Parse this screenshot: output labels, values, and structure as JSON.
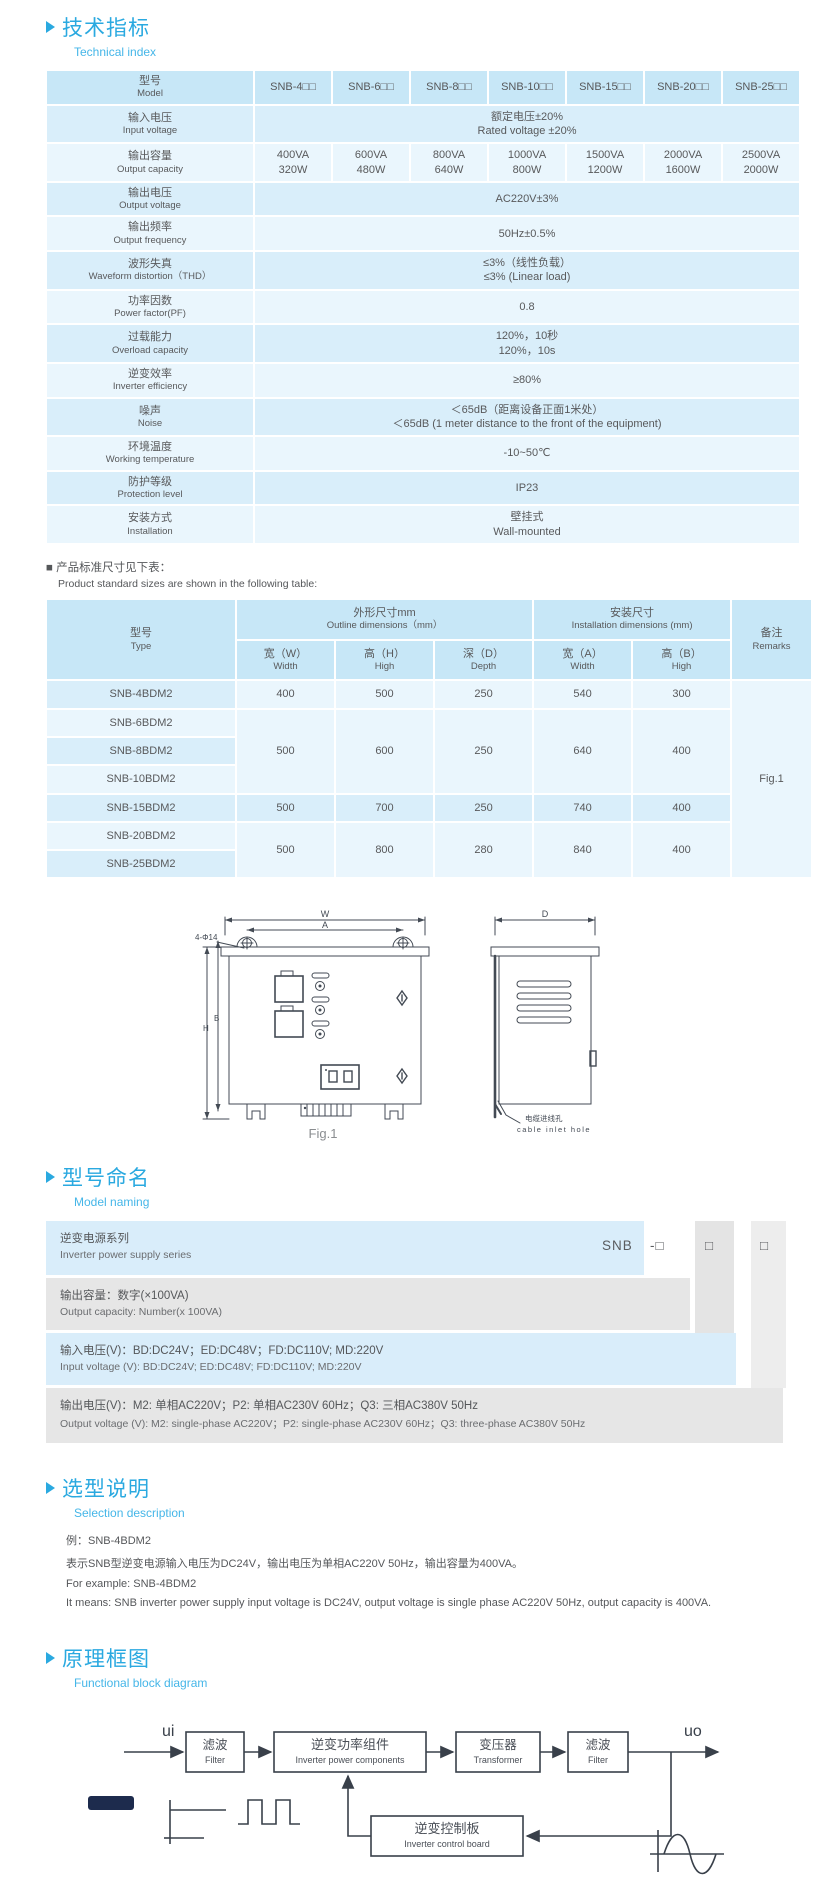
{
  "colors": {
    "heading_blue": "#2aa9e0",
    "subtitle_blue": "#45b6e8",
    "table_header_bg": "#c7e7f7",
    "row_dark": "#d9eefa",
    "row_light": "#eaf6fd",
    "naming_gray": "#e6e6e6",
    "line_dark": "#3a414b"
  },
  "sections": {
    "technical": {
      "title": "技术指标",
      "subtitle": "Technical index"
    },
    "naming": {
      "title": "型号命名",
      "subtitle": "Model naming"
    },
    "selection": {
      "title": "选型说明",
      "subtitle": "Selection description"
    },
    "diagram": {
      "title": "原理框图",
      "subtitle": "Functional block diagram"
    }
  },
  "spec_table": {
    "header": {
      "label_zh": "型号",
      "label_en": "Model",
      "models": [
        "SNB-4□□",
        "SNB-6□□",
        "SNB-8□□",
        "SNB-10□□",
        "SNB-15□□",
        "SNB-20□□",
        "SNB-25□□"
      ]
    },
    "rows": [
      {
        "zh": "输入电压",
        "en": "Input voltage",
        "val_zh": "额定电压±20%",
        "val_en": "Rated voltage ±20%"
      },
      {
        "zh": "输出容量",
        "en": "Output capacity",
        "cells": [
          {
            "va": "400VA",
            "w": "320W"
          },
          {
            "va": "600VA",
            "w": "480W"
          },
          {
            "va": "800VA",
            "w": "640W"
          },
          {
            "va": "1000VA",
            "w": "800W"
          },
          {
            "va": "1500VA",
            "w": "1200W"
          },
          {
            "va": "2000VA",
            "w": "1600W"
          },
          {
            "va": "2500VA",
            "w": "2000W"
          }
        ]
      },
      {
        "zh": "输出电压",
        "en": "Output voltage",
        "val_zh": "AC220V±3%",
        "val_en": ""
      },
      {
        "zh": "输出频率",
        "en": "Output frequency",
        "val_zh": "50Hz±0.5%",
        "val_en": ""
      },
      {
        "zh": "波形失真",
        "en": "Waveform distortion（THD）",
        "val_zh": "≤3%（线性负载）",
        "val_en": "≤3% (Linear load)"
      },
      {
        "zh": "功率因数",
        "en": "Power factor(PF)",
        "val_zh": "0.8",
        "val_en": ""
      },
      {
        "zh": "过载能力",
        "en": "Overload capacity",
        "val_zh": "120%，10秒",
        "val_en": "120%，10s"
      },
      {
        "zh": "逆变效率",
        "en": "Inverter efficiency",
        "val_zh": "≥80%",
        "val_en": ""
      },
      {
        "zh": "噪声",
        "en": "Noise",
        "val_zh": "＜65dB（距离设备正面1米处）",
        "val_en": "＜65dB (1 meter distance to the front of the equipment)"
      },
      {
        "zh": "环境温度",
        "en": "Working temperature",
        "val_zh": "-10~50℃",
        "val_en": ""
      },
      {
        "zh": "防护等级",
        "en": "Protection level",
        "val_zh": "IP23",
        "val_en": ""
      },
      {
        "zh": "安装方式",
        "en": "Installation",
        "val_zh": "壁挂式",
        "val_en": "Wall-mounted"
      }
    ]
  },
  "sizes_note": {
    "zh": "■ 产品标准尺寸见下表：",
    "en": "Product standard sizes are shown in the following table:"
  },
  "sizes_table": {
    "header": {
      "type_zh": "型号",
      "type_en": "Type",
      "outline_zh": "外形尺寸mm",
      "outline_en": "Outline dimensions（mm）",
      "install_zh": "安装尺寸",
      "install_en": "Installation dimensions (mm)",
      "remarks_zh": "备注",
      "remarks_en": "Remarks",
      "cols": [
        {
          "zh": "宽（W）",
          "en": "Width"
        },
        {
          "zh": "高（H）",
          "en": "High"
        },
        {
          "zh": "深（D）",
          "en": "Depth"
        },
        {
          "zh": "宽（A）",
          "en": "Width"
        },
        {
          "zh": "高（B）",
          "en": "High"
        }
      ]
    },
    "types": [
      "SNB-4BDM2",
      "SNB-6BDM2",
      "SNB-8BDM2",
      "SNB-10BDM2",
      "SNB-15BDM2",
      "SNB-20BDM2",
      "SNB-25BDM2"
    ],
    "groups": [
      {
        "w": "400",
        "h": "500",
        "d": "250",
        "a": "540",
        "b": "300"
      },
      {
        "w": "500",
        "h": "600",
        "d": "250",
        "a": "640",
        "b": "400"
      },
      {
        "w": "500",
        "h": "700",
        "d": "250",
        "a": "740",
        "b": "400"
      },
      {
        "w": "500",
        "h": "800",
        "d": "280",
        "a": "840",
        "b": "400"
      }
    ],
    "remark": "Fig.1"
  },
  "figure": {
    "caption": "Fig.1",
    "hole_note": "4-Φ14",
    "dim_w": "W",
    "dim_a": "A",
    "dim_d": "D",
    "dim_h": "H",
    "dim_b": "B",
    "cable_note_zh": "电缆进线孔",
    "cable_note_en": "cable inlet hole"
  },
  "naming": {
    "code_parts": [
      "SNB",
      "-□",
      "□",
      "□"
    ],
    "rows": [
      {
        "zh": "逆变电源系列",
        "en": "Inverter power supply series"
      },
      {
        "zh": "输出容量：数字(×100VA)",
        "en": "Output capacity: Number(x 100VA)"
      },
      {
        "zh": "输入电压(V)：BD:DC24V；ED:DC48V；FD:DC110V; MD:220V",
        "en": "Input voltage (V): BD:DC24V;  ED:DC48V;  FD:DC110V; MD:220V"
      },
      {
        "zh": "输出电压(V)：M2: 单相AC220V；P2: 单相AC230V 60Hz；Q3: 三相AC380V 50Hz",
        "en": "Output voltage (V):  M2: single-phase AC220V；P2: single-phase AC230V 60Hz；Q3: three-phase AC380V 50Hz"
      }
    ]
  },
  "selection": {
    "example_zh": "例：SNB-4BDM2",
    "desc_zh": "表示SNB型逆变电源输入电压为DC24V，输出电压为单相AC220V 50Hz，输出容量为400VA。",
    "example_en": "For example: SNB-4BDM2",
    "desc_en": "It means: SNB inverter power supply input voltage is DC24V, output voltage is single phase AC220V 50Hz, output capacity is 400VA."
  },
  "diagram": {
    "input_label": "ui",
    "output_label": "uo",
    "blocks": [
      {
        "zh": "滤波",
        "en": "Filter"
      },
      {
        "zh": "逆变功率组件",
        "en": "Inverter power components"
      },
      {
        "zh": "变压器",
        "en": "Transformer"
      },
      {
        "zh": "滤波",
        "en": "Filter"
      },
      {
        "zh": "逆变控制板",
        "en": "Inverter control board"
      }
    ]
  }
}
